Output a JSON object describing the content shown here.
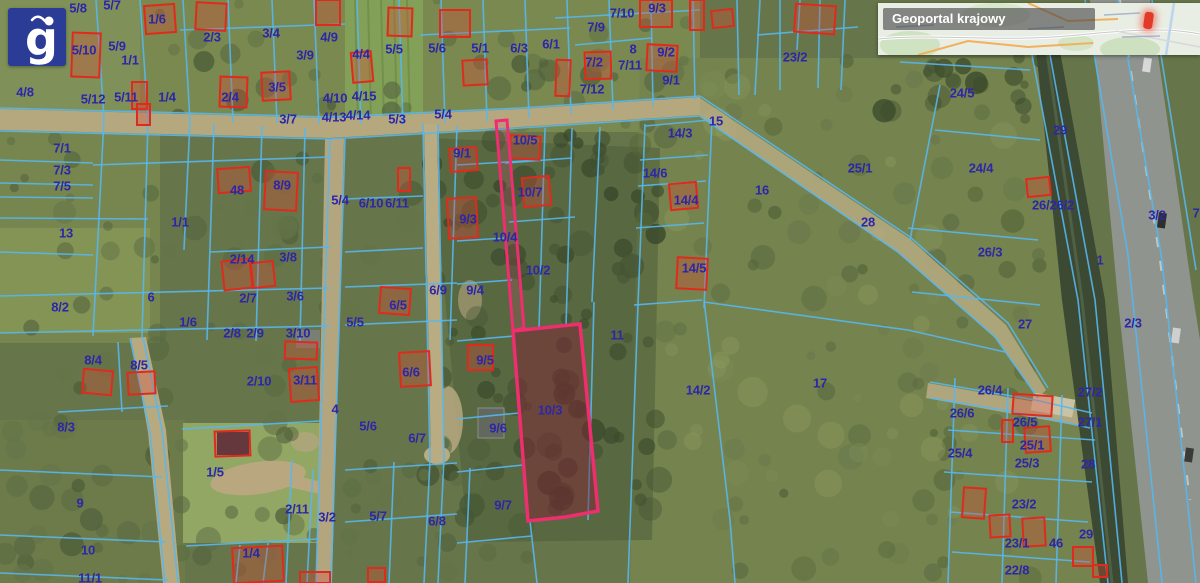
{
  "app": {
    "logo_letter": "g"
  },
  "minimap": {
    "title": "Geoportal krajowy"
  },
  "map": {
    "label_color": "#2d26a9",
    "boundary_color": "#57b7f0",
    "building_color": "#df2b1d",
    "highlight_color": "#ee2e6e",
    "highlighted_parcel_id": "10/3",
    "parcel_labels": [
      [
        "5/8",
        78,
        8
      ],
      [
        "5/7",
        112,
        5
      ],
      [
        "1/6",
        157,
        19
      ],
      [
        "2/3",
        212,
        37
      ],
      [
        "3/4",
        271,
        33
      ],
      [
        "3/9",
        305,
        55
      ],
      [
        "4/9",
        329,
        37
      ],
      [
        "5/10",
        84,
        50
      ],
      [
        "5/9",
        117,
        46
      ],
      [
        "1/1",
        130,
        60
      ],
      [
        "4/4",
        361,
        54
      ],
      [
        "5/12",
        93,
        99
      ],
      [
        "5/11",
        126,
        97
      ],
      [
        "1/4",
        167,
        97
      ],
      [
        "2/4",
        230,
        97
      ],
      [
        "3/5",
        277,
        87
      ],
      [
        "4/10",
        335,
        98
      ],
      [
        "4/15",
        364,
        96
      ],
      [
        "3/7",
        288,
        119
      ],
      [
        "4/13",
        334,
        117
      ],
      [
        "4/14",
        358,
        115
      ],
      [
        "5/3",
        397,
        119
      ],
      [
        "5/4",
        443,
        114
      ],
      [
        "5/5",
        394,
        49
      ],
      [
        "5/6",
        437,
        48
      ],
      [
        "5/1",
        480,
        48
      ],
      [
        "6/3",
        519,
        48
      ],
      [
        "6/1",
        551,
        44
      ],
      [
        "7/9",
        596,
        27
      ],
      [
        "7/10",
        622,
        13
      ],
      [
        "9/3",
        657,
        8
      ],
      [
        "7/2",
        594,
        62
      ],
      [
        "7/11",
        630,
        65
      ],
      [
        "8",
        633,
        49
      ],
      [
        "9/2",
        666,
        52
      ],
      [
        "9/1",
        671,
        80
      ],
      [
        "7/12",
        592,
        89
      ],
      [
        "23/2",
        795,
        57
      ],
      [
        "24/5",
        962,
        93
      ],
      [
        "29",
        1060,
        130
      ],
      [
        "25/1",
        860,
        168
      ],
      [
        "24/4",
        981,
        168
      ],
      [
        "26/26/2",
        1053,
        205
      ],
      [
        "3/2",
        1157,
        215
      ],
      [
        "7",
        1196,
        213
      ],
      [
        "26/3",
        990,
        252
      ],
      [
        "1",
        1100,
        260
      ],
      [
        "27",
        1025,
        324
      ],
      [
        "2/3",
        1133,
        323
      ],
      [
        "15",
        716,
        121
      ],
      [
        "14/3",
        680,
        133
      ],
      [
        "14/6",
        655,
        173
      ],
      [
        "14/4",
        686,
        200
      ],
      [
        "16",
        762,
        190
      ],
      [
        "14/5",
        694,
        268
      ],
      [
        "28",
        868,
        222
      ],
      [
        "11",
        617,
        335
      ],
      [
        "14/2",
        698,
        390
      ],
      [
        "17",
        820,
        383
      ],
      [
        "4/8",
        25,
        92
      ],
      [
        "7/1",
        62,
        148
      ],
      [
        "7/3",
        62,
        170
      ],
      [
        "7/5",
        62,
        186
      ],
      [
        "13",
        66,
        233
      ],
      [
        "8/2",
        60,
        307
      ],
      [
        "6",
        151,
        297
      ],
      [
        "1/1",
        180,
        222
      ],
      [
        "48",
        237,
        190
      ],
      [
        "8/9",
        282,
        185
      ],
      [
        "5/4",
        340,
        200
      ],
      [
        "6/10",
        371,
        203
      ],
      [
        "6/11",
        397,
        203
      ],
      [
        "2/14",
        242,
        259
      ],
      [
        "3/8",
        288,
        257
      ],
      [
        "2/7",
        248,
        298
      ],
      [
        "3/6",
        295,
        296
      ],
      [
        "1/6",
        188,
        322
      ],
      [
        "5/5",
        355,
        322
      ],
      [
        "6/5",
        398,
        305
      ],
      [
        "2/8",
        232,
        333
      ],
      [
        "2/9",
        255,
        333
      ],
      [
        "3/10",
        298,
        333
      ],
      [
        "6/9",
        438,
        290
      ],
      [
        "9/4",
        475,
        290
      ],
      [
        "9/1",
        462,
        153
      ],
      [
        "10/5",
        525,
        140
      ],
      [
        "10/7",
        530,
        192
      ],
      [
        "9/3",
        468,
        219
      ],
      [
        "10/4",
        505,
        237
      ],
      [
        "10/2",
        538,
        270
      ],
      [
        "10/3",
        550,
        410
      ],
      [
        "9/5",
        485,
        360
      ],
      [
        "9/6",
        498,
        428
      ],
      [
        "9/7",
        503,
        505
      ],
      [
        "8/4",
        93,
        360
      ],
      [
        "8/5",
        139,
        365
      ],
      [
        "8/3",
        66,
        427
      ],
      [
        "9",
        80,
        503
      ],
      [
        "10",
        88,
        550
      ],
      [
        "11/1",
        90,
        578
      ],
      [
        "1/5",
        215,
        472
      ],
      [
        "2/10",
        259,
        381
      ],
      [
        "3/11",
        305,
        380
      ],
      [
        "4",
        335,
        409
      ],
      [
        "5/6",
        368,
        426
      ],
      [
        "6/6",
        411,
        372
      ],
      [
        "6/7",
        417,
        438
      ],
      [
        "2/11",
        297,
        509
      ],
      [
        "3/2",
        327,
        517
      ],
      [
        "5/7",
        378,
        516
      ],
      [
        "6/8",
        437,
        521
      ],
      [
        "1/4",
        251,
        553
      ],
      [
        "26/4",
        990,
        390
      ],
      [
        "27/2",
        1090,
        392
      ],
      [
        "26/6",
        962,
        413
      ],
      [
        "26/5",
        1025,
        422
      ],
      [
        "27/1",
        1090,
        422
      ],
      [
        "25/1",
        1032,
        445
      ],
      [
        "25/4",
        960,
        453
      ],
      [
        "25/3",
        1027,
        463
      ],
      [
        "28",
        1088,
        464
      ],
      [
        "23/2",
        1024,
        504
      ],
      [
        "23/1",
        1017,
        543
      ],
      [
        "46",
        1056,
        543
      ],
      [
        "29",
        1086,
        534
      ],
      [
        "22/8",
        1017,
        570
      ]
    ],
    "buildings": [
      [
        145,
        5,
        30,
        28,
        -4
      ],
      [
        196,
        3,
        30,
        27,
        3
      ],
      [
        316,
        0,
        24,
        25,
        0
      ],
      [
        352,
        52,
        20,
        30,
        -5
      ],
      [
        388,
        8,
        24,
        28,
        2
      ],
      [
        440,
        10,
        30,
        27,
        0
      ],
      [
        463,
        60,
        24,
        25,
        -3
      ],
      [
        556,
        60,
        14,
        36,
        2
      ],
      [
        585,
        52,
        26,
        27,
        -2
      ],
      [
        647,
        45,
        30,
        26,
        3
      ],
      [
        690,
        0,
        14,
        30,
        0
      ],
      [
        640,
        0,
        32,
        27,
        0
      ],
      [
        712,
        10,
        21,
        17,
        -6
      ],
      [
        795,
        5,
        40,
        28,
        4
      ],
      [
        72,
        33,
        28,
        44,
        2
      ],
      [
        262,
        72,
        28,
        28,
        -3
      ],
      [
        220,
        77,
        27,
        30,
        2
      ],
      [
        132,
        82,
        15,
        27,
        0
      ],
      [
        137,
        104,
        13,
        21,
        0
      ],
      [
        218,
        168,
        32,
        24,
        -4
      ],
      [
        265,
        172,
        32,
        38,
        3
      ],
      [
        223,
        260,
        28,
        29,
        -6
      ],
      [
        252,
        262,
        22,
        25,
        -6
      ],
      [
        380,
        288,
        30,
        26,
        4
      ],
      [
        450,
        148,
        27,
        23,
        -4
      ],
      [
        510,
        136,
        30,
        23,
        3
      ],
      [
        523,
        177,
        27,
        29,
        -5
      ],
      [
        448,
        198,
        29,
        40,
        -3
      ],
      [
        468,
        345,
        25,
        25,
        0
      ],
      [
        670,
        183,
        27,
        26,
        -5
      ],
      [
        677,
        258,
        30,
        31,
        3
      ],
      [
        400,
        352,
        30,
        34,
        -3
      ],
      [
        285,
        342,
        32,
        17,
        2
      ],
      [
        290,
        368,
        28,
        33,
        -4
      ],
      [
        215,
        431,
        35,
        25,
        -2
      ],
      [
        83,
        370,
        29,
        24,
        5
      ],
      [
        128,
        372,
        27,
        22,
        -3
      ],
      [
        233,
        547,
        50,
        35,
        -3
      ],
      [
        300,
        572,
        30,
        11,
        0
      ],
      [
        1013,
        395,
        39,
        20,
        4
      ],
      [
        1025,
        427,
        25,
        25,
        -4
      ],
      [
        1002,
        420,
        11,
        22,
        0
      ],
      [
        963,
        488,
        22,
        30,
        4
      ],
      [
        990,
        515,
        20,
        22,
        -3
      ],
      [
        1023,
        518,
        22,
        28,
        -3
      ],
      [
        1073,
        547,
        20,
        19,
        0
      ],
      [
        368,
        568,
        17,
        14,
        0
      ],
      [
        1027,
        178,
        23,
        18,
        -6
      ],
      [
        398,
        168,
        12,
        23,
        0
      ],
      [
        1093,
        565,
        14,
        12,
        0
      ]
    ],
    "highlight": {
      "strip": "496,121 507,120 524,328 513,331",
      "parcel": "513,331 580,324 598,511 566,517 528,521"
    },
    "cadastral_paths": [
      "M96,0 L104,118",
      "M140,0 L148,120",
      "M183,0 L190,121",
      "M228,0 L233,122",
      "M272,0 L277,123",
      "M314,0 L319,124",
      "M357,0 L361,124",
      "M399,0 L403,124",
      "M441,0 L445,123",
      "M483,0 L487,121",
      "M525,0 L529,118",
      "M567,0 L571,114",
      "M609,0 L613,110",
      "M651,0 L653,106",
      "M693,0 L695,100",
      "M737,0 L739,95",
      "M780,0 L780,90",
      "M820,0 L818,88",
      "M180,30 L345,24",
      "M420,35 L570,28",
      "M575,45 L652,38",
      "M555,18 L700,10",
      "M0,108 L330,117 L520,108 L700,96",
      "M0,131 L330,139 L520,128 L700,116",
      "M700,96 L910,237 L1008,323 L1048,388",
      "M700,116 L898,252 L995,337 L1038,398",
      "M104,118 L93,336",
      "M148,120 L142,337",
      "M190,121 L184,250",
      "M214,124 L207,340",
      "M262,126 L256,341",
      "M305,128 L300,342",
      "M330,139 L316,583",
      "M345,139 L331,583",
      "M423,124 L430,460 L424,583",
      "M438,124 L444,458 L438,583",
      "M457,126 L450,340",
      "M545,128 L539,328",
      "M572,128 L566,326",
      "M600,127 L592,302",
      "M645,124 L638,305",
      "M712,118 L704,308",
      "M93,165 L330,157",
      "M0,160 L93,163",
      "M0,183 L93,185",
      "M0,197 L93,198",
      "M0,218 L148,219",
      "M0,252 L93,255",
      "M0,296 L330,288",
      "M345,287 L457,283",
      "M0,333 L330,326",
      "M345,325 L457,320",
      "M210,252 L330,247",
      "M345,199 L423,196",
      "M345,252 L423,248",
      "M457,165 L540,160",
      "M457,241 L505,238",
      "M457,284 L512,280",
      "M457,341 L514,336",
      "M457,419 L519,413",
      "M457,472 L523,465",
      "M505,163 L572,158",
      "M509,222 L575,217",
      "M512,330 L580,324",
      "M645,126 L710,120",
      "M640,160 L708,155",
      "M638,186 L706,181",
      "M636,228 L704,223",
      "M634,305 L702,300",
      "M638,305 L628,583",
      "M704,300 L730,520 L735,583",
      "M704,302 L908,330",
      "M908,330 L1005,352",
      "M910,240 L940,85",
      "M900,62 L1030,70",
      "M935,130 L1040,140",
      "M908,228 L1038,240",
      "M912,292 L1040,305",
      "M1032,55 L1078,300 L1108,583",
      "M1050,55 L1095,300 L1122,583",
      "M1085,0 L1128,255 L1162,583",
      "M1118,0 L1162,260 L1196,583",
      "M1152,0 L1196,270",
      "M930,382 L1035,400 L1092,413",
      "M930,398 L1032,415 L1090,428",
      "M948,430 L1095,440",
      "M944,472 L1092,482",
      "M950,512 L1088,522",
      "M952,552 L1090,562",
      "M955,378 L948,583",
      "M1008,388 L1002,583",
      "M1062,395 L1056,583",
      "M143,337 L162,430 L178,583",
      "M130,338 L150,432 L165,583",
      "M118,342 L122,412",
      "M58,412 L168,406",
      "M0,470 L162,477",
      "M0,535 L166,542",
      "M0,573 L168,580",
      "M182,429 L320,421",
      "M186,546 L318,539",
      "M240,545 L236,583",
      "M268,543 L263,583",
      "M292,460 L286,583",
      "M313,470 L307,583",
      "M394,462 L389,583",
      "M470,468 L465,583",
      "M345,470 L457,463",
      "M345,522 L457,514",
      "M457,543 L532,536",
      "M530,521 L537,583",
      "M594,302 L588,520",
      "M760,0 L755,95",
      "M800,0 L797,50",
      "M757,35 L858,27",
      "M845,0 L841,90"
    ]
  }
}
